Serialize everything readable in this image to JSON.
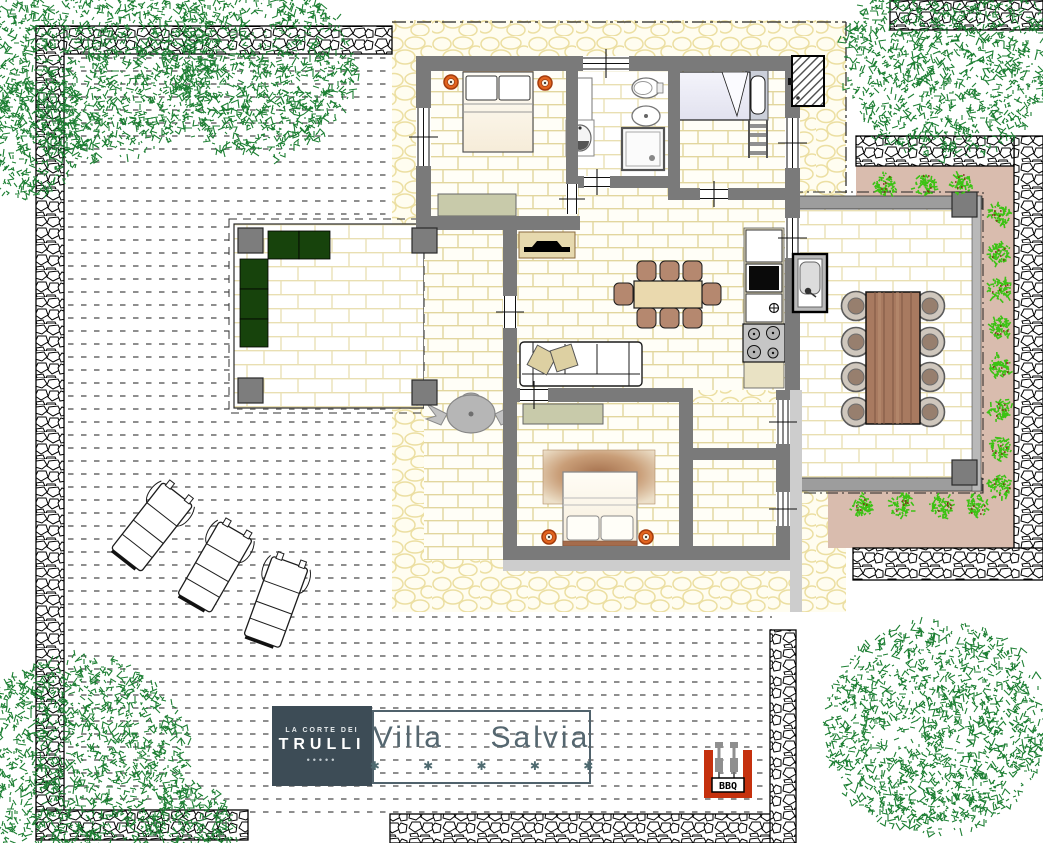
{
  "branding": {
    "logo_top": "LA CORTE DEI",
    "logo_main": "TRULLI",
    "logo_dots": "•••••",
    "villa_title": "Villa  Salvia",
    "villa_stars": "✱ ✱ ✱ ✱ ✱",
    "stars_count": 5
  },
  "labels": {
    "bbq": "BBQ"
  },
  "icons": {
    "bbq": "bbq-grill",
    "lounger": "sun-lounger",
    "tree": "tree-canopy",
    "bush": "garden-bush",
    "urn": "decorative-urn"
  },
  "colors": {
    "wall_gray": "#7a7a7a",
    "pillar_gray": "#7d7d7d",
    "logo_slate": "#3d4c56",
    "title_text": "#556770",
    "tile_line": "#e2d69e",
    "cobble_line": "#ecdfa2",
    "accent_orange": "#e2641e",
    "bbq_red": "#c5310e",
    "sofa_green": "#17430c",
    "garden_pink": "#d9bcae",
    "bush_green": "#3cc214",
    "tree_green": "#1d7f33",
    "wood_brown": "#a87a60",
    "chair_brown": "#b5886f",
    "sage": "#c8caaa",
    "rug_brown": "#a46f4c"
  }
}
